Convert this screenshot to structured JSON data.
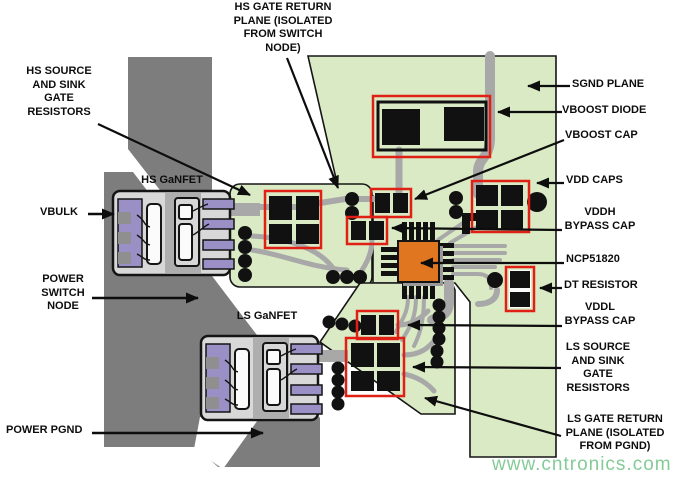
{
  "labels": {
    "hs_plane": "HS GATE RETURN\nPLANE (ISOLATED\nFROM SWITCH\nNODE)",
    "hs_res": "HS SOURCE\nAND SINK\nGATE\nRESISTORS",
    "hs_ganfet": "HS GaNFET",
    "vbulk": "VBULK",
    "power_switch": "POWER\nSWITCH\nNODE",
    "ls_ganfet": "LS GaNFET",
    "power_pgnd": "POWER PGND",
    "sgnd": "SGND PLANE",
    "vboost_diode": "VBOOST DIODE",
    "vboost_cap": "VBOOST CAP",
    "vdd_caps": "VDD CAPS",
    "vddh_cap": "VDDH\nBYPASS CAP",
    "ncp": "NCP51820",
    "dt_res": "DT RESISTOR",
    "vddl_cap": "VDDL\nBYPASS CAP",
    "ls_res": "LS SOURCE\nAND SINK\nGATE\nRESISTORS",
    "ls_plane": "LS GATE RETURN\nPLANE (ISOLATED\nFROM PGND)"
  },
  "watermark": "www.cntronics.com",
  "ic_part_number": "NCP51820",
  "colors": {
    "board_green": "#d9eac5",
    "copper_gray": "#7d7d7d",
    "trace_gray": "#a8a8a8",
    "ic_orange": "#e0761f",
    "pad_purple": "#9b90c6",
    "highlight_red": "#e02015",
    "watermark_green": "#85cb98"
  }
}
